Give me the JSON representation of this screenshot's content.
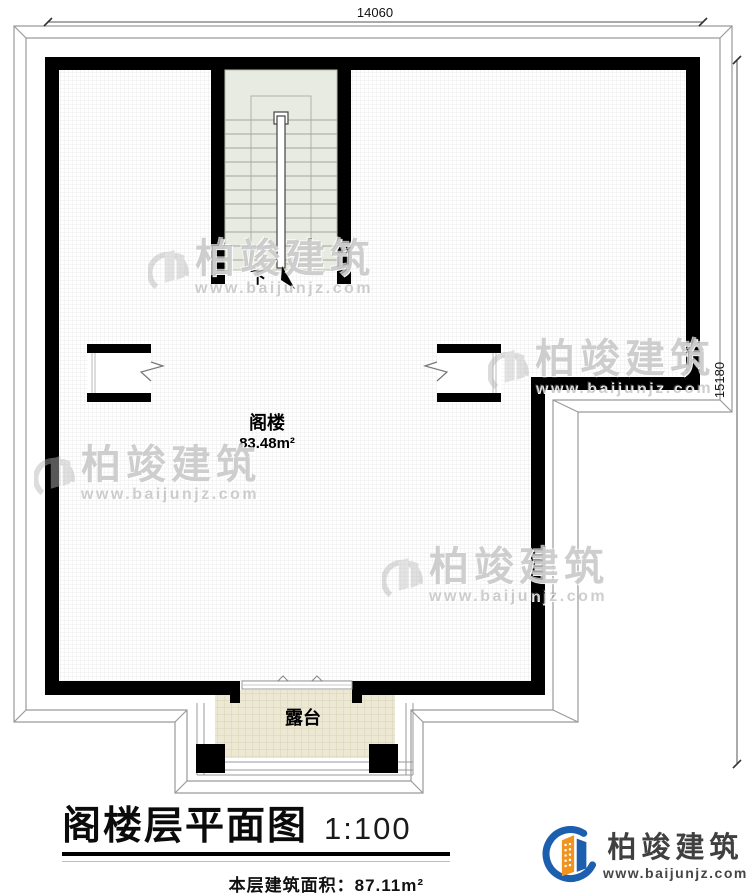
{
  "plan": {
    "dimensions": {
      "top": "14060",
      "right": "15180"
    },
    "rooms": {
      "attic": {
        "name": "阁楼",
        "area": "83.48m²"
      },
      "terrace": {
        "name": "露台"
      },
      "stairs": {
        "direction_label": "下"
      }
    }
  },
  "title_block": {
    "title": "阁楼层平面图",
    "scale": "1:100",
    "area_label": "本层建筑面积：87.11m²"
  },
  "watermark": {
    "brand": "柏竣建筑",
    "url": "www.baijunjz.com"
  },
  "logo": {
    "brand": "柏竣建筑",
    "url": "www.baijunjz.com"
  },
  "colors": {
    "wall": "#000000",
    "roof_line": "#9a9a9a",
    "stair_fill": "#e7ebe1",
    "terrace_fill": "#ece8d4",
    "logo_blue": "#1b5fae",
    "logo_orange": "#f0931f",
    "title_text": "#111111",
    "logo_text": "#404040"
  }
}
